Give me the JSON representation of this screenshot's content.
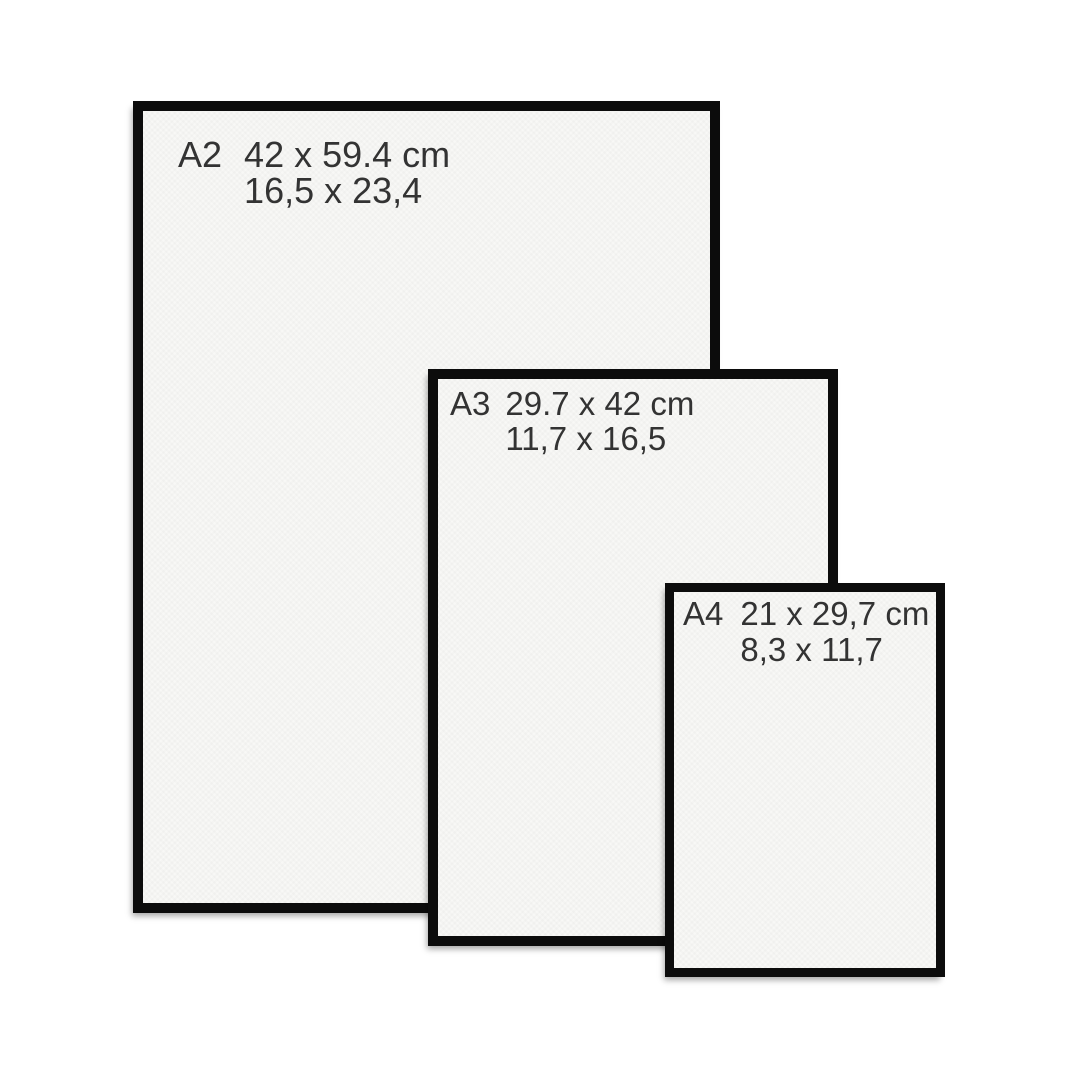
{
  "colors": {
    "background": "#ffffff",
    "frame-border": "#0c0c0c",
    "paper": "#f8f8f6",
    "text": "#333333"
  },
  "frames": [
    {
      "id": "a2",
      "label": "A2",
      "size_cm": "42 x 59.4 cm",
      "size_secondary": "16,5 x 23,4"
    },
    {
      "id": "a3",
      "label": "A3",
      "size_cm": "29.7 x 42 cm",
      "size_secondary": "11,7 x 16,5"
    },
    {
      "id": "a4",
      "label": "A4",
      "size_cm": "21 x 29,7 cm",
      "size_secondary": "8,3 x 11,7"
    }
  ]
}
